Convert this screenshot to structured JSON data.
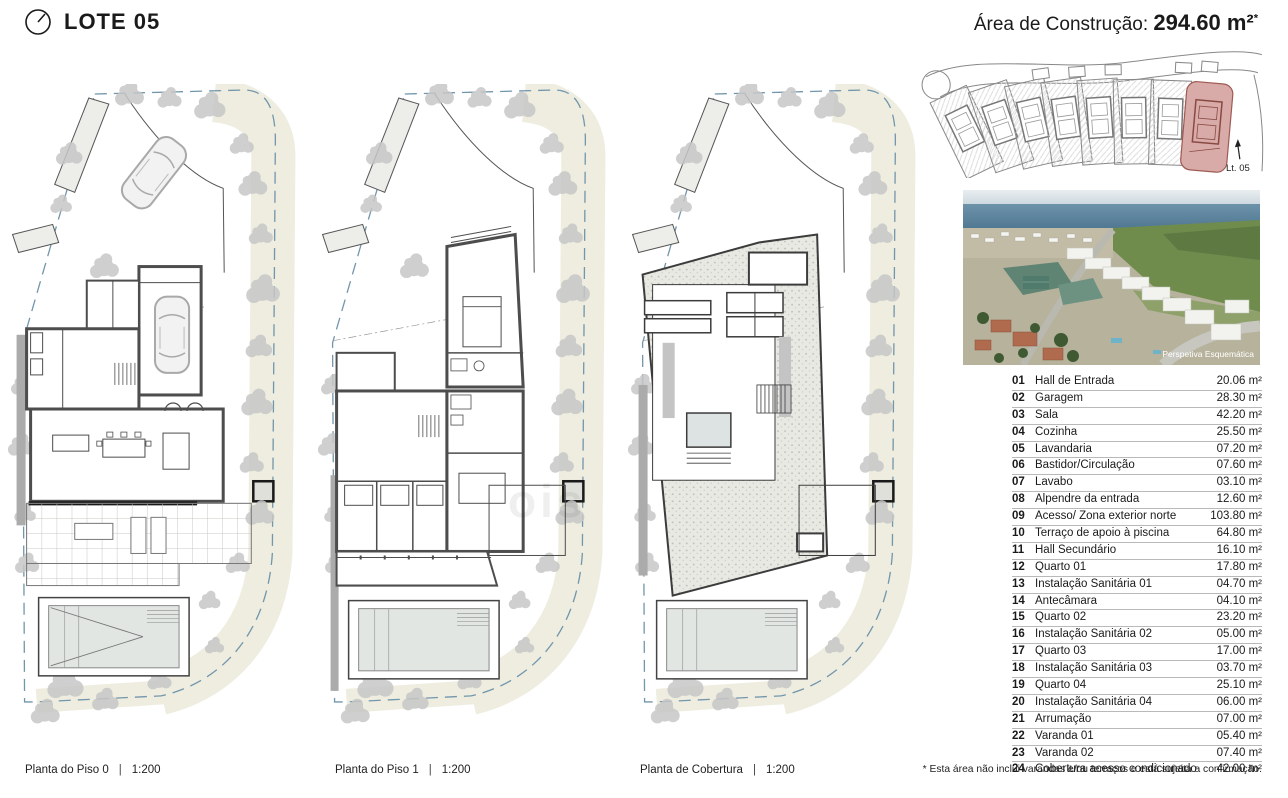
{
  "header": {
    "lot_title": "LOTE 05",
    "area_label": "Área de Construção:",
    "area_value": "294.60",
    "area_unit": "m²",
    "area_note_mark": "*"
  },
  "site_plan": {
    "highlight_label": "Lt. 05",
    "highlight_color": "#d8aba8"
  },
  "aerial": {
    "caption": "Perspetiva Esquemática"
  },
  "plans": [
    {
      "caption": "Planta do Piso 0",
      "divider": "|",
      "scale": "1:200"
    },
    {
      "caption": "Planta do Piso 1",
      "divider": "|",
      "scale": "1:200"
    },
    {
      "caption": "Planta de Cobertura",
      "divider": "|",
      "scale": "1:200"
    }
  ],
  "rooms": [
    {
      "num": "01",
      "name": "Hall de Entrada",
      "area": "20.06 m²"
    },
    {
      "num": "02",
      "name": "Garagem",
      "area": "28.30 m²"
    },
    {
      "num": "03",
      "name": "Sala",
      "area": "42.20 m²"
    },
    {
      "num": "04",
      "name": "Cozinha",
      "area": "25.50 m²"
    },
    {
      "num": "05",
      "name": "Lavandaria",
      "area": "07.20 m²"
    },
    {
      "num": "06",
      "name": "Bastidor/Circulação",
      "area": "07.60 m²"
    },
    {
      "num": "07",
      "name": "Lavabo",
      "area": "03.10 m²"
    },
    {
      "num": "08",
      "name": "Alpendre da entrada",
      "area": "12.60 m²"
    },
    {
      "num": "09",
      "name": "Acesso/ Zona exterior norte",
      "area": "103.80 m²"
    },
    {
      "num": "10",
      "name": "Terraço de apoio à piscina",
      "area": "64.80 m²"
    },
    {
      "num": "11",
      "name": "Hall Secundário",
      "area": "16.10 m²"
    },
    {
      "num": "12",
      "name": "Quarto 01",
      "area": "17.80 m²"
    },
    {
      "num": "13",
      "name": "Instalação Sanitária 01",
      "area": "04.70 m²"
    },
    {
      "num": "14",
      "name": "Antecâmara",
      "area": "04.10 m²"
    },
    {
      "num": "15",
      "name": "Quarto 02",
      "area": "23.20 m²"
    },
    {
      "num": "16",
      "name": "Instalação Sanitária 02",
      "area": "05.00 m²"
    },
    {
      "num": "17",
      "name": "Quarto 03",
      "area": "17.00 m²"
    },
    {
      "num": "18",
      "name": "Instalação Sanitária 03",
      "area": "03.70 m²"
    },
    {
      "num": "19",
      "name": "Quarto 04",
      "area": "25.10 m²"
    },
    {
      "num": "20",
      "name": "Instalação Sanitária 04",
      "area": "06.00 m²"
    },
    {
      "num": "21",
      "name": "Arrumação",
      "area": "07.00 m²"
    },
    {
      "num": "22",
      "name": "Varanda 01",
      "area": "05.40 m²"
    },
    {
      "num": "23",
      "name": "Varanda 02",
      "area": "07.40 m²"
    },
    {
      "num": "24",
      "name": "Cobertura acesso condicionado",
      "area": "42.00 m²"
    }
  ],
  "footnote": "* Esta área não inclui varandas e/ou terraços e está sujeita a confirmação.",
  "watermark": "ois"
}
